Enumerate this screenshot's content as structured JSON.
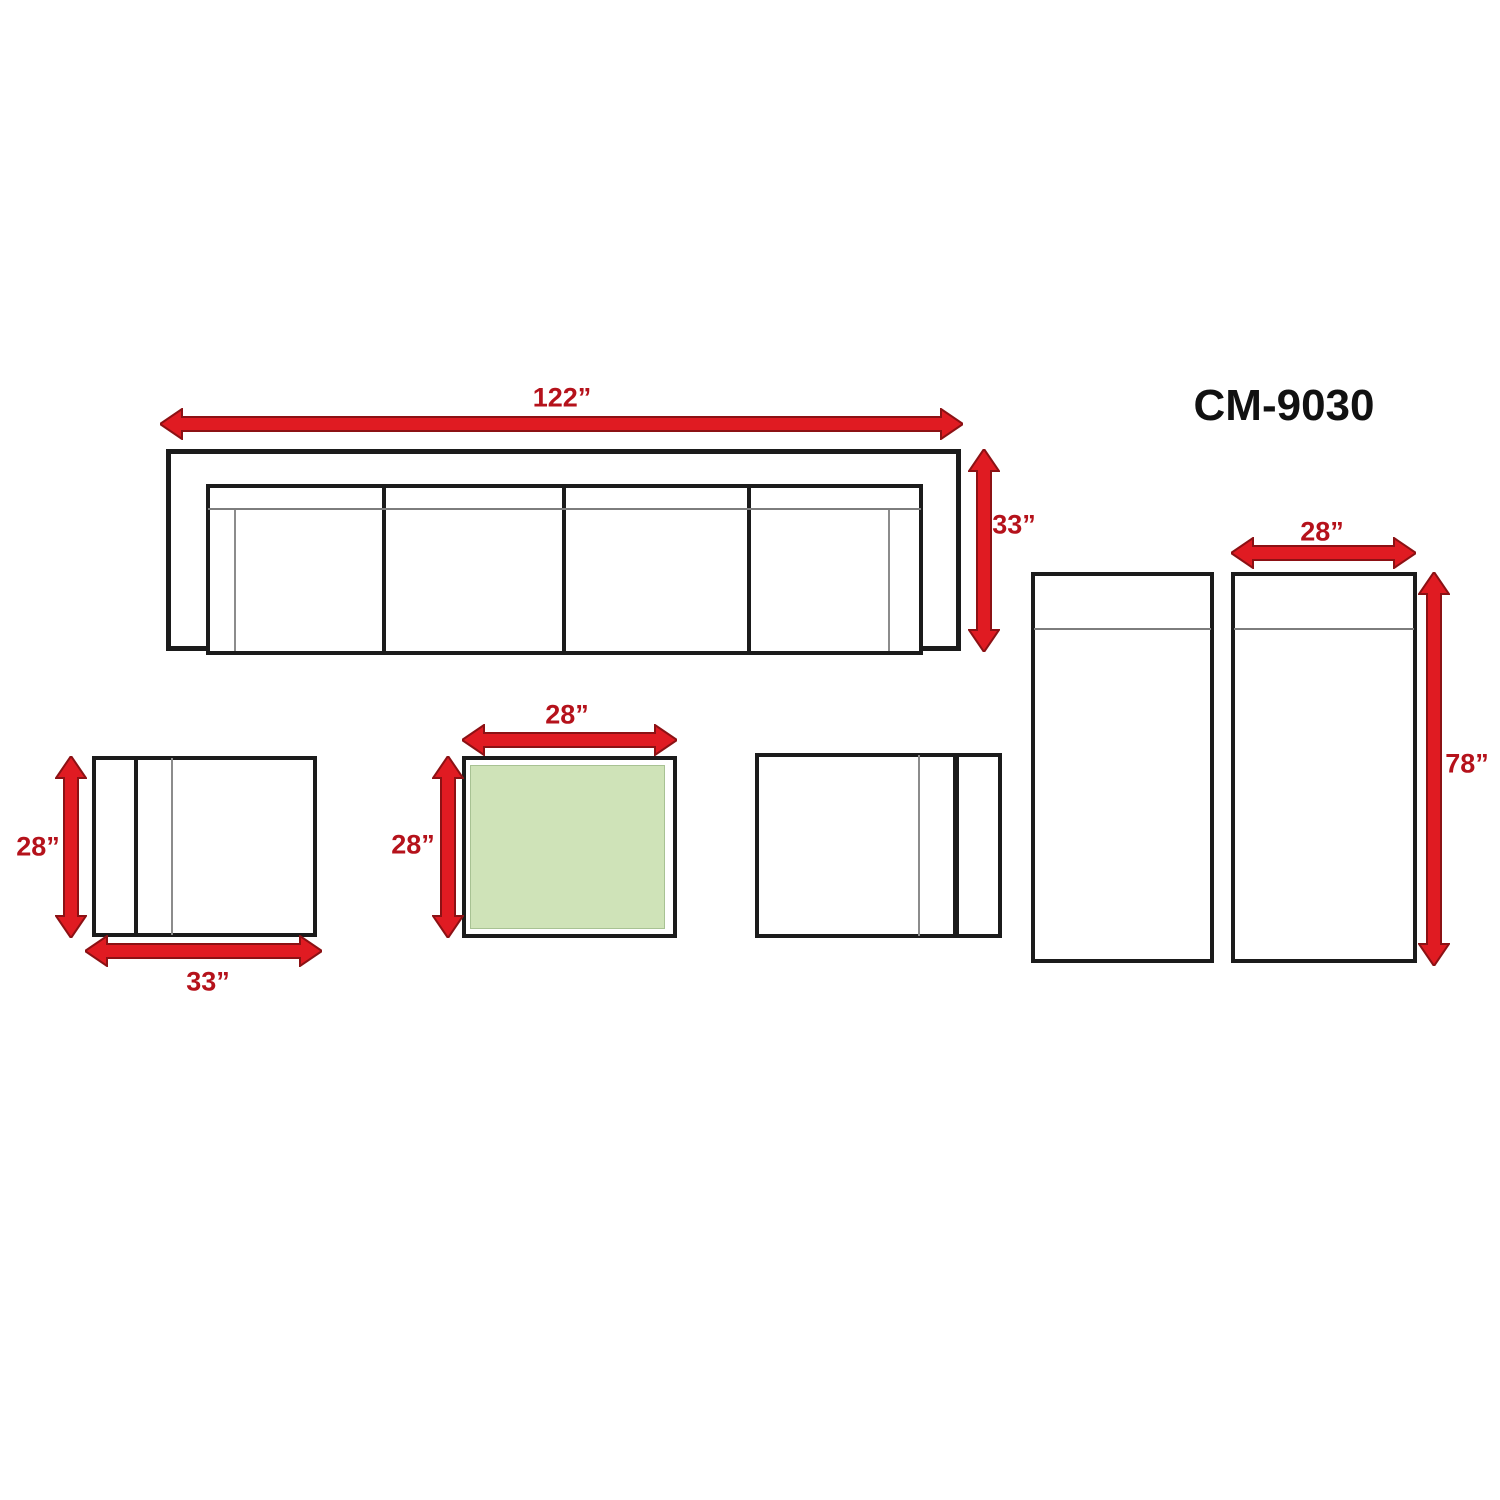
{
  "title": "CM-9030",
  "sofa": {
    "width_label": "122”",
    "depth_label": "33”"
  },
  "left_chair": {
    "depth_label": "28”",
    "width_label": "33”"
  },
  "coffee_table": {
    "width_label": "28”",
    "depth_label": "28”"
  },
  "chaise": {
    "width_label": "28”",
    "length_label": "78”"
  },
  "colors": {
    "outline": "#1b1b1b",
    "arrow_fill": "#e01b22",
    "arrow_stroke": "#8c1114",
    "dimension_text": "#b5121b",
    "title_text": "#111111",
    "table_top_fill": "#cfe3b8",
    "thin_line": "#8c8c8c"
  }
}
